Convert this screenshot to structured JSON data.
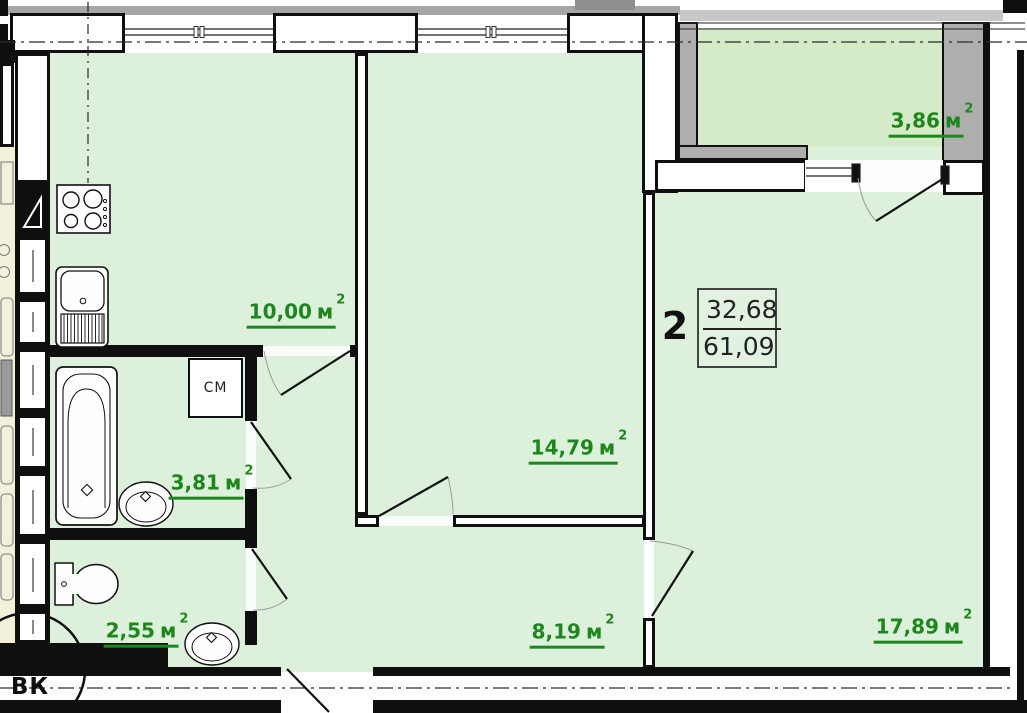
{
  "apartment_card": {
    "room_count": "2",
    "living_area": "32,68",
    "total_area": "61,09"
  },
  "room_labels": {
    "kitchen": {
      "value": "10,00",
      "unit": "м",
      "sup": "2"
    },
    "bedroom": {
      "value": "14,79",
      "unit": "м",
      "sup": "2"
    },
    "bathroom": {
      "value": "3,81",
      "unit": "м",
      "sup": "2"
    },
    "wc": {
      "value": "2,55",
      "unit": "м",
      "sup": "2"
    },
    "hallway": {
      "value": "8,19",
      "unit": "м",
      "sup": "2"
    },
    "living_room": {
      "value": "17,89",
      "unit": "м",
      "sup": "2"
    },
    "balcony": {
      "value": "3,86",
      "unit": "м",
      "sup": "2"
    }
  },
  "markers": {
    "washing_machine": "СМ",
    "vent_shaft": "ВК"
  },
  "colors": {
    "room_fill": "#ddf0dc",
    "balcony_fill": "#d5ebc8",
    "label_green": "#1d871d",
    "wall_black": "#0f0f0f",
    "balcony_wall_gray": "#aeaeae",
    "neighbor_fill": "#f2efda"
  }
}
